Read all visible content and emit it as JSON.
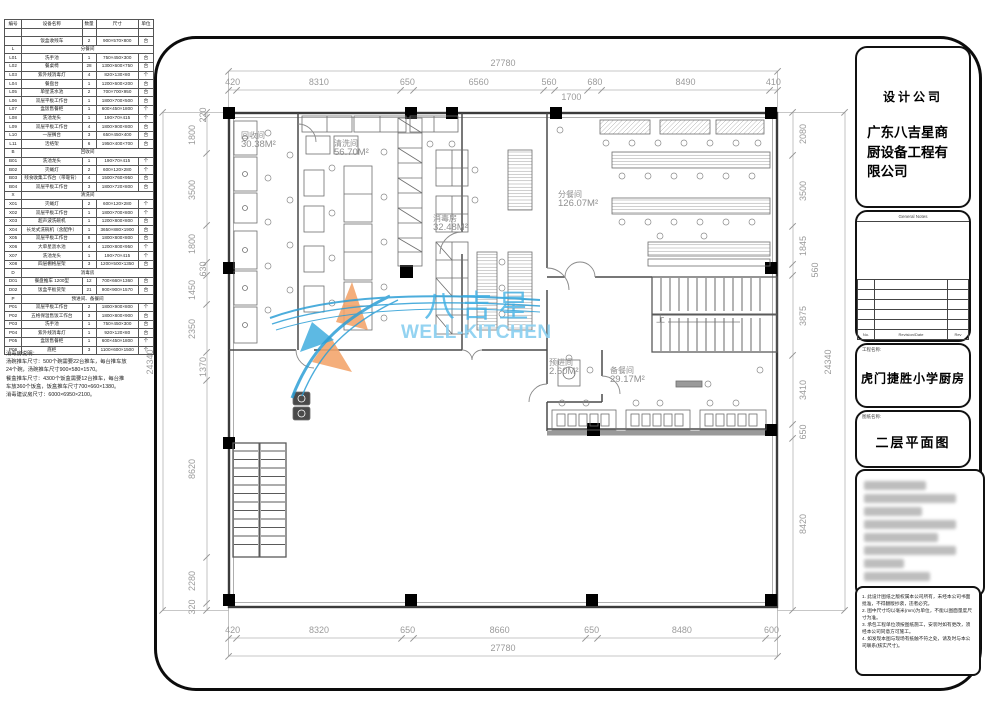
{
  "equipment_table": {
    "headers": [
      "编号",
      "设备名称",
      "数量",
      "尺寸",
      "单位"
    ],
    "rows": [
      {
        "no": "",
        "name": "",
        "qty": "",
        "size": "",
        "unit": ""
      },
      {
        "no": "",
        "name": "饭盒收残车",
        "qty": "2",
        "size": "900×570×800",
        "unit": "台"
      },
      {
        "no": "L",
        "name": "分餐间",
        "section": true
      },
      {
        "no": "L01",
        "name": "洗手池",
        "qty": "1",
        "size": "750×450×300",
        "unit": "台"
      },
      {
        "no": "L02",
        "name": "餐桌椅",
        "qty": "28",
        "size": "1300×600×750",
        "unit": "台"
      },
      {
        "no": "L03",
        "name": "紫外线消毒灯",
        "qty": "4",
        "size": "820×130×80",
        "unit": "个"
      },
      {
        "no": "L04",
        "name": "餐盘台",
        "qty": "1",
        "size": "1200×600×200",
        "unit": "台"
      },
      {
        "no": "L05",
        "name": "单星洗水池",
        "qty": "2",
        "size": "700×700×950",
        "unit": "台"
      },
      {
        "no": "L06",
        "name": "双层平板工作台",
        "qty": "1",
        "size": "1800×700×500",
        "unit": "台"
      },
      {
        "no": "L07",
        "name": "盒饭售餐柜",
        "qty": "1",
        "size": "600×450×1800",
        "unit": "个"
      },
      {
        "no": "L08",
        "name": "洗池龙头",
        "qty": "1",
        "size": "190×70×415",
        "unit": "个"
      },
      {
        "no": "L09",
        "name": "双层平板工作台",
        "qty": "4",
        "size": "1800×900×800",
        "unit": "台"
      },
      {
        "no": "L10",
        "name": "一层搁台",
        "qty": "3",
        "size": "650×450×400",
        "unit": "台"
      },
      {
        "no": "L11",
        "name": "活络架",
        "qty": "6",
        "size": "1950×400×700",
        "unit": "台"
      },
      {
        "no": "B",
        "name": "回收间",
        "section": true
      },
      {
        "no": "B01",
        "name": "洗池龙头",
        "qty": "1",
        "size": "190×70×415",
        "unit": "个"
      },
      {
        "no": "B02",
        "name": "灭蝇灯",
        "qty": "2",
        "size": "600×120×280",
        "unit": "个"
      },
      {
        "no": "B03",
        "name": "残食收集工作台（带靠背）",
        "qty": "4",
        "size": "1500×760×950",
        "unit": "台"
      },
      {
        "no": "B04",
        "name": "双层平板工作台",
        "qty": "3",
        "size": "1800×720×800",
        "unit": "台"
      },
      {
        "no": "X",
        "name": "清洗间",
        "section": true
      },
      {
        "no": "X01",
        "name": "灭蝇灯",
        "qty": "2",
        "size": "600×120×280",
        "unit": "个"
      },
      {
        "no": "X02",
        "name": "双层平板工作台",
        "qty": "1",
        "size": "1800×700×800",
        "unit": "个"
      },
      {
        "no": "X03",
        "name": "超声波洗碗机",
        "qty": "1",
        "size": "1200×800×800",
        "unit": "台"
      },
      {
        "no": "X04",
        "name": "长龙式洗碗机（含配件）",
        "qty": "1",
        "size": "3650×880×1900",
        "unit": "台"
      },
      {
        "no": "X05",
        "name": "双层平板工作台",
        "qty": "8",
        "size": "1800×800×800",
        "unit": "台"
      },
      {
        "no": "X06",
        "name": "大单星沥水池",
        "qty": "4",
        "size": "1200×800×950",
        "unit": "个"
      },
      {
        "no": "X07",
        "name": "洗池龙头",
        "qty": "1",
        "size": "190×70×415",
        "unit": "个"
      },
      {
        "no": "X08",
        "name": "四层棚格层架",
        "qty": "3",
        "size": "1200×500×1350",
        "unit": "台"
      },
      {
        "no": "D",
        "name": "消毒房",
        "section": true
      },
      {
        "no": "D01",
        "name": "餐盘推车 1200型",
        "qty": "12",
        "size": "700×660×1360",
        "unit": "台"
      },
      {
        "no": "D02",
        "name": "饭盒平板货架",
        "qty": "21",
        "size": "900×900×1570",
        "unit": "台"
      },
      {
        "no": "P",
        "name": "预进间、备餐间",
        "section": true
      },
      {
        "no": "P01",
        "name": "双层平板工作台",
        "qty": "2",
        "size": "1800×900×800",
        "unit": "个"
      },
      {
        "no": "P02",
        "name": "五格保温售饭工作台",
        "qty": "3",
        "size": "1800×800×900",
        "unit": "台"
      },
      {
        "no": "P03",
        "name": "洗手池",
        "qty": "1",
        "size": "750×450×300",
        "unit": "台"
      },
      {
        "no": "P04",
        "name": "紫外线消毒灯",
        "qty": "1",
        "size": "920×120×80",
        "unit": "台"
      },
      {
        "no": "P05",
        "name": "盒饭售餐柜",
        "qty": "1",
        "size": "600×450×1800",
        "unit": "个"
      },
      {
        "no": "P06",
        "name": "底柜",
        "qty": "3",
        "size": "1100×600×1500",
        "unit": "个"
      }
    ],
    "note_lines": [
      "消毒房说明：",
      "汤碗推车尺寸：500个碗需要22台推车，每台推车放",
      "24个碗，汤碗推车尺寸900×580×1570。",
      "餐盒推车尺寸：4300个饭盒需要12台推车，每台推",
      "车放360个饭盒，饭盒推车尺寸700×660×1380。",
      "消毒建议房尺寸：6000×6950×2100。"
    ]
  },
  "plan": {
    "rooms": [
      {
        "name": "回收间",
        "area": "30.38M²"
      },
      {
        "name": "清洗间",
        "area": "56.70M²"
      },
      {
        "name": "消毒房",
        "area": "32.48M²"
      },
      {
        "name": "分餐间",
        "area": "126.07M²"
      },
      {
        "name": "预进间",
        "area": "2.60M²"
      },
      {
        "name": "备餐间",
        "area": "29.17M²"
      }
    ],
    "stair_up_label": "上",
    "dims": {
      "top": {
        "total": "27780",
        "segments": [
          "420",
          "8310",
          "650",
          "6560",
          "560",
          "1700",
          "680",
          "8490",
          "410"
        ]
      },
      "bottom": {
        "total": "27780",
        "segments": [
          "420",
          "8320",
          "650",
          "8660",
          "650",
          "8480",
          "600"
        ]
      },
      "left": {
        "total": "24340",
        "segments": [
          "220",
          "1800",
          "3500",
          "1800",
          "630",
          "1450",
          "2350",
          "1370",
          "8620",
          "2280",
          "320"
        ]
      },
      "right": {
        "total": "24340",
        "segments": [
          "2080",
          "3500",
          "1845",
          "560",
          "3875",
          "3410",
          "650",
          "8420"
        ]
      }
    }
  },
  "watermark": {
    "cn": "八吉星",
    "en": "WELL-KITCHEN",
    "blue": "#3fb0e5",
    "light_blue": "#8bd0f0",
    "orange": "#f2a369"
  },
  "titleblock": {
    "design_company_label": "设计公司",
    "company_name": "广东八吉星商厨设备工程有限公司",
    "general_notes_label": "General Notes",
    "revision_footer": {
      "no": "No.",
      "mid": "Revision/Date",
      "rev": "Rev"
    },
    "project_label": "工程名称:",
    "project_name": "虎门捷胜小学厨房",
    "drawing_label": "图纸名称:",
    "drawing_name": "二层平面图",
    "notes": [
      "1. 此设计图纸之版权属本公司所有，未经本公司书面批准，不得翻版抄袭，违者必究。",
      "2. 图中尺寸均以毫米(mm)为单位，不能以图面量度尺寸为准。",
      "3. 承包工程单位须按图纸施工，安装时如有更改，须经本公司同意方可施工。",
      "4. 如发现本图与现场有抵触不符之处，请及时与本公司联系(核实尺寸)。"
    ]
  }
}
